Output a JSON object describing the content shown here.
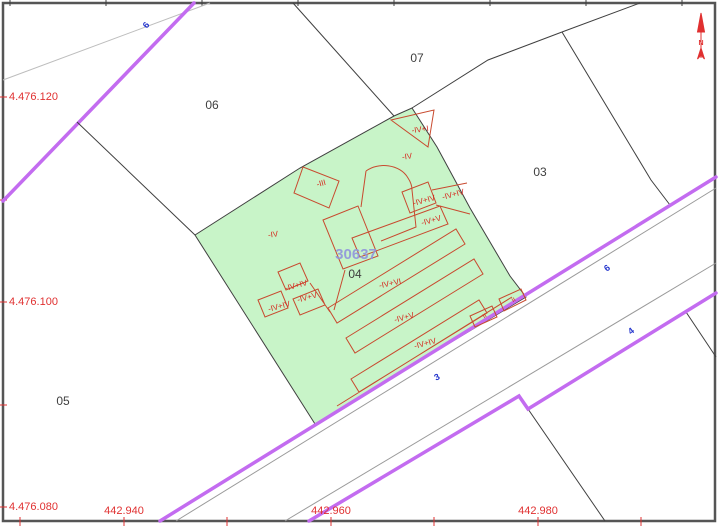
{
  "colors": {
    "border-gray": "#555555",
    "boundary-black": "#3f3f3f",
    "road-purple": "#c36cf0",
    "road-gray": "#9a9a9a",
    "faint-gray": "#bdbdbd",
    "parcel-green": "#c8f4c8",
    "building-red": "#c84a2f",
    "label-red": "#d6281e",
    "coord-red": "#e03030",
    "street-blue": "#2233cc",
    "ref-blue": "#9094dc",
    "parcel-num-gray": "#3f3f3f"
  },
  "map": {
    "reference": {
      "text": "30637"
    },
    "north": {
      "letter": "N"
    },
    "parcels": [
      {
        "number": "06"
      },
      {
        "number": "07"
      },
      {
        "number": "03"
      },
      {
        "number": "04"
      },
      {
        "number": "05"
      }
    ],
    "streets": [
      {
        "number": "6"
      },
      {
        "number": "6"
      },
      {
        "number": "4"
      },
      {
        "number": "3"
      }
    ],
    "buildings": [
      {
        "code": "-IV+I"
      },
      {
        "code": "-IV"
      },
      {
        "code": "-III"
      },
      {
        "code": "-IV+IV"
      },
      {
        "code": "-IV+IV"
      },
      {
        "code": "-IV+V"
      },
      {
        "code": "-IV"
      },
      {
        "code": "-IV+IV"
      },
      {
        "code": "-IV+V"
      },
      {
        "code": "-IV+IV"
      },
      {
        "code": "-IV+VI"
      },
      {
        "code": "-IV+V"
      },
      {
        "code": "-IV+IV"
      },
      {
        "code": "II"
      },
      {
        "code": "II"
      }
    ],
    "grid": {
      "y": [
        {
          "label": "4.476.120"
        },
        {
          "label": "4.476.100"
        },
        {
          "label": "4.476.080"
        }
      ],
      "x": [
        {
          "label": "442.940"
        },
        {
          "label": "442.960"
        },
        {
          "label": "442.980"
        }
      ]
    }
  }
}
